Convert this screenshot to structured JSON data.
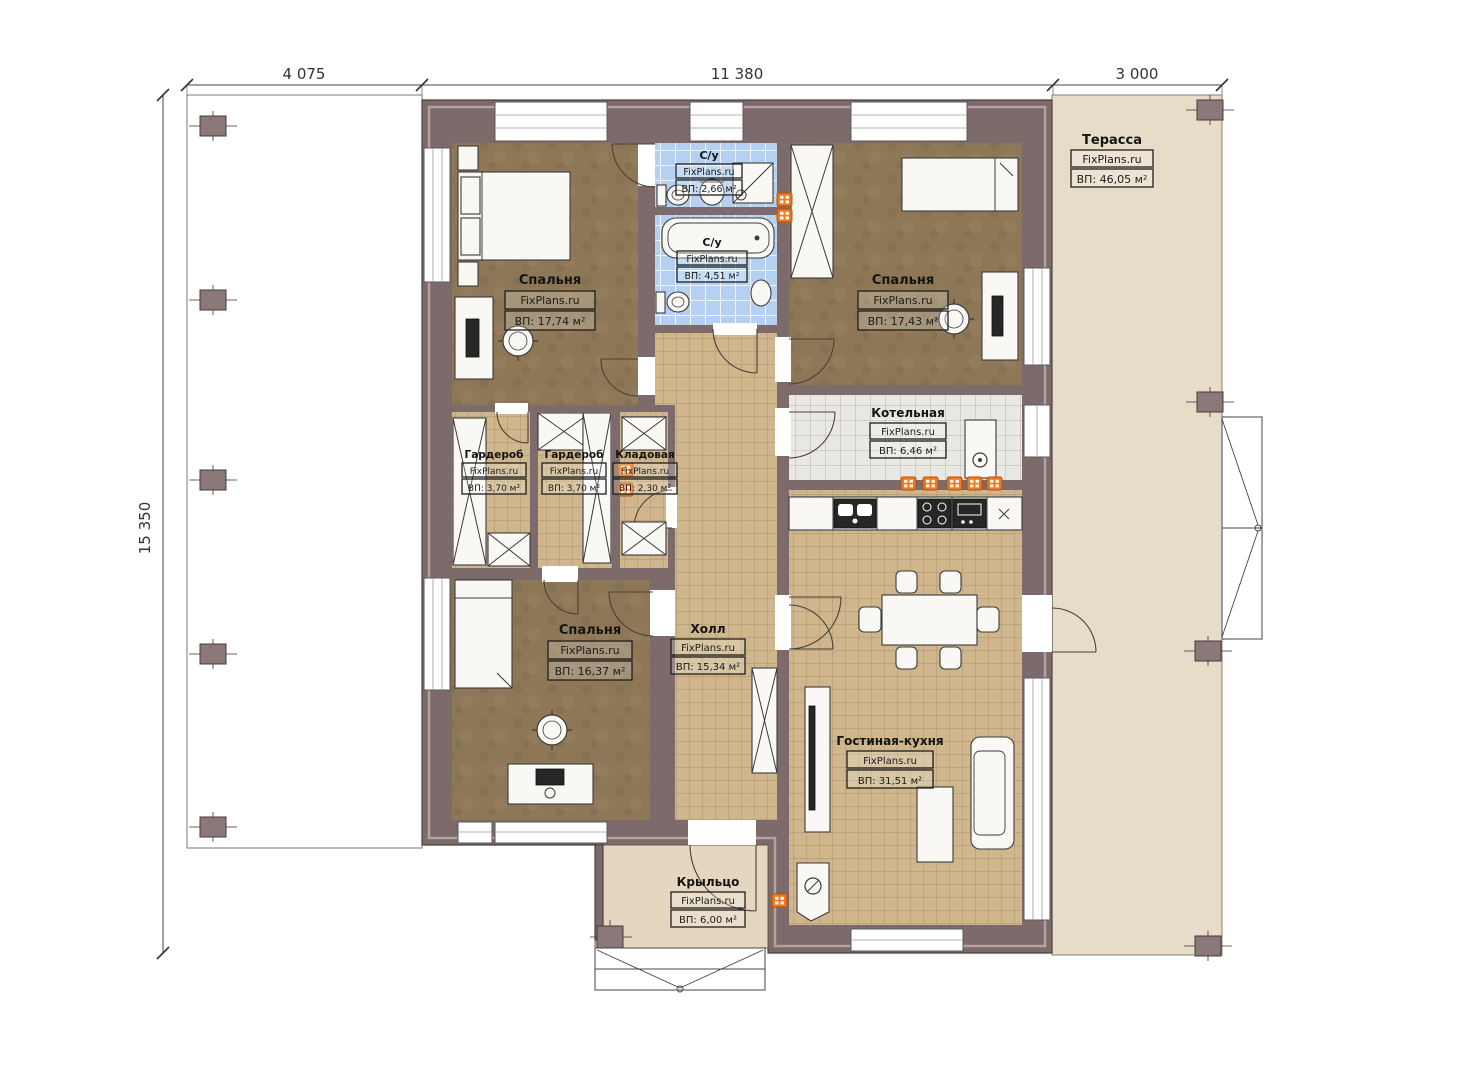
{
  "watermark": "FixPlans.ru",
  "dimensions": {
    "top": [
      "4 075",
      "11 380",
      "3 000"
    ],
    "left": "15 350"
  },
  "rooms": [
    {
      "name": "Спальня",
      "area": "ВП: 17,74 м²"
    },
    {
      "name": "С/у",
      "area": "ВП: 2,66 м²"
    },
    {
      "name": "С/у",
      "area": "ВП: 4,51 м²"
    },
    {
      "name": "Спальня",
      "area": "ВП: 17,43 м²"
    },
    {
      "name": "Терасса",
      "area": "ВП: 46,05 м²"
    },
    {
      "name": "Котельная",
      "area": "ВП: 6,46 м²"
    },
    {
      "name": "Гардероб",
      "area": "ВП: 3,70 м²"
    },
    {
      "name": "Гардероб",
      "area": "ВП: 3,70 м²"
    },
    {
      "name": "Кладовая",
      "area": "ВП: 2,30 м²"
    },
    {
      "name": "Спальня",
      "area": "ВП: 16,37 м²"
    },
    {
      "name": "Холл",
      "area": "ВП: 15,34 м²"
    },
    {
      "name": "Гостиная-кухня",
      "area": "ВП: 31,51 м²"
    },
    {
      "name": "Крыльцо",
      "area": "ВП: 6,00 м²"
    }
  ],
  "colors": {
    "wall": "#7d6a6a",
    "terrace_floor": "#e7dcc8",
    "porch_floor": "#e5d6bf",
    "bedroom_floor": "#8d7757",
    "bath_tile": "#b5d0f0",
    "hall_tile": "#cfb68c",
    "boiler_tile": "#eae8e3",
    "radiator": "#f0791f"
  }
}
